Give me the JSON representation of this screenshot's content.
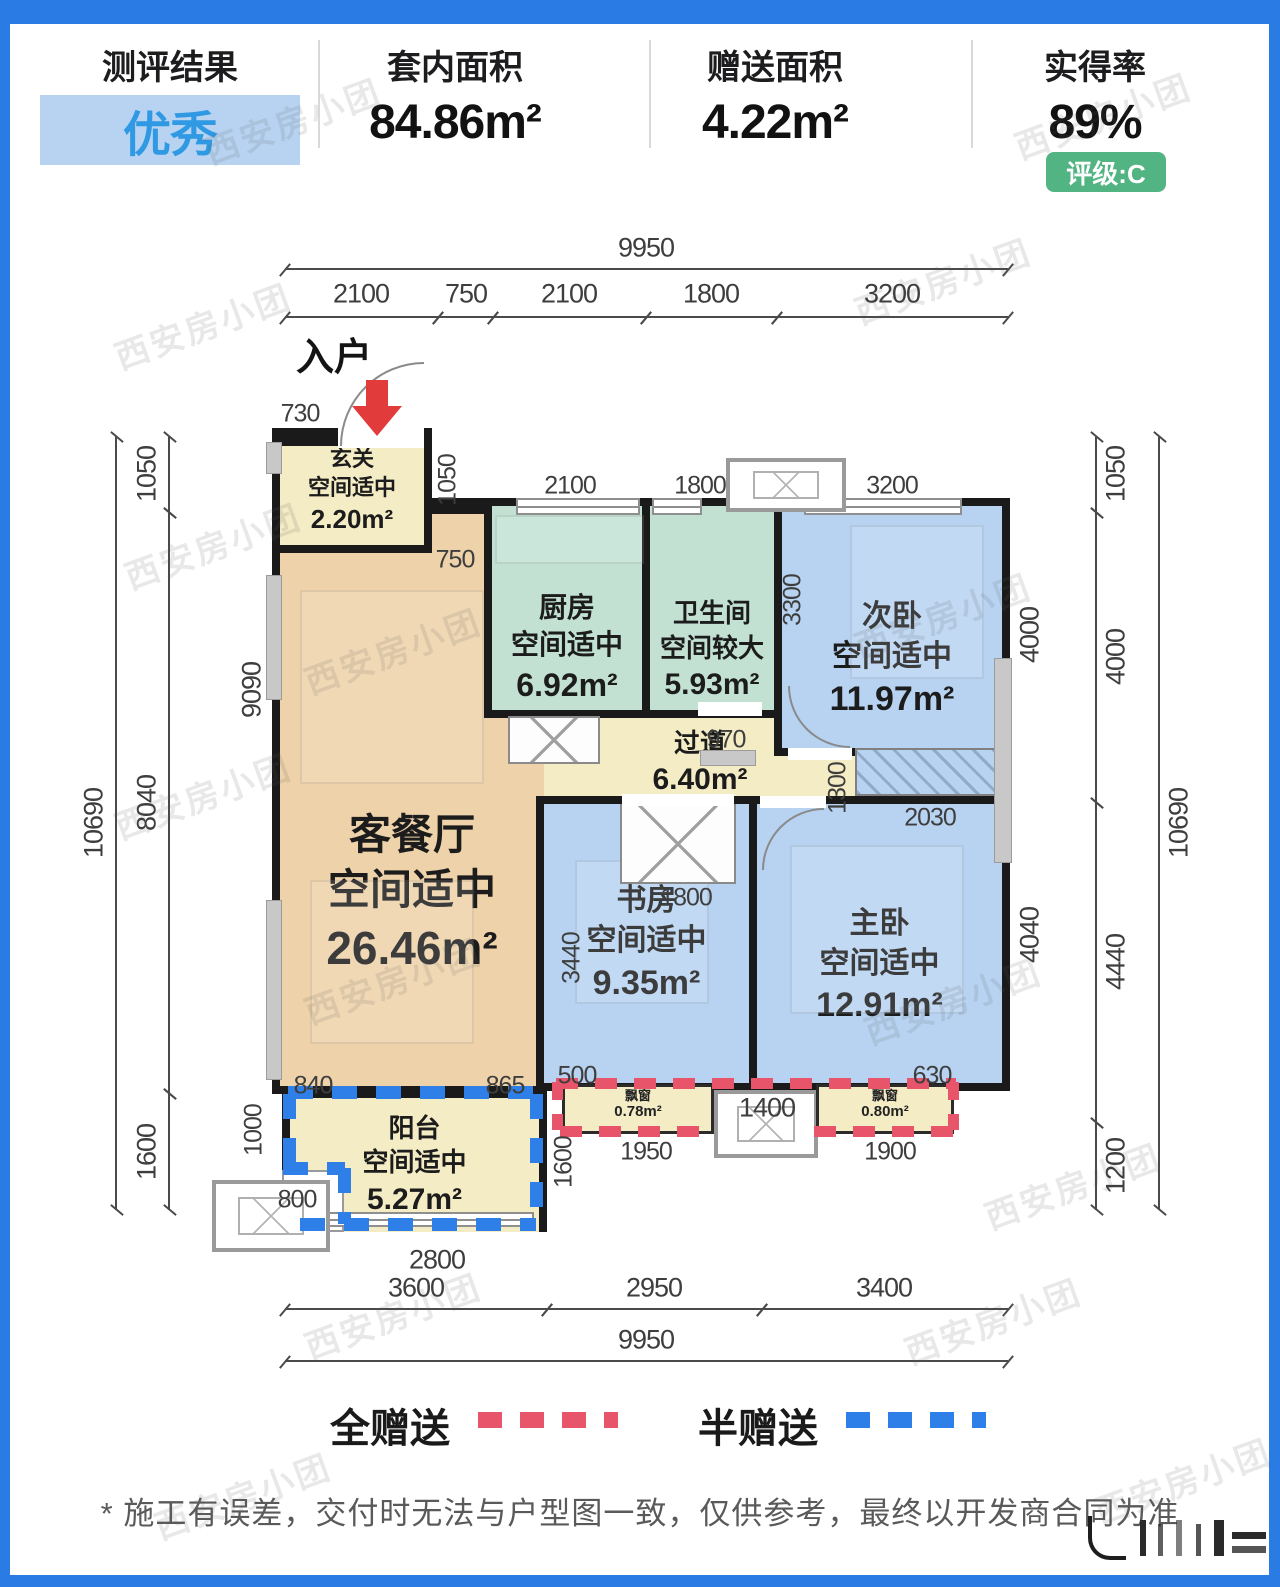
{
  "header": {
    "items": [
      {
        "label": "测评结果",
        "value": "优秀"
      },
      {
        "label": "套内面积",
        "value": "84.86m²"
      },
      {
        "label": "赠送面积",
        "value": "4.22m²"
      },
      {
        "label": "实得率",
        "value": "89%"
      }
    ],
    "rating_badge": "评级:C"
  },
  "plan": {
    "entrance_label": "入户",
    "rooms": [
      {
        "name": "玄关",
        "assessment": "空间适中",
        "area": "2.20m²"
      },
      {
        "name": "客餐厅",
        "assessment": "空间适中",
        "area": "26.46m²"
      },
      {
        "name": "厨房",
        "assessment": "空间适中",
        "area": "6.92m²"
      },
      {
        "name": "卫生间",
        "assessment": "空间较大",
        "area": "5.93m²"
      },
      {
        "name": "次卧",
        "assessment": "空间适中",
        "area": "11.97m²"
      },
      {
        "name": "过道",
        "assessment": "",
        "area": "6.40m²"
      },
      {
        "name": "书房",
        "assessment": "空间适中",
        "area": "9.35m²"
      },
      {
        "name": "主卧",
        "assessment": "空间适中",
        "area": "12.91m²"
      },
      {
        "name": "阳台",
        "assessment": "空间适中",
        "area": "5.27m²"
      }
    ],
    "bay_windows": [
      {
        "label": "飘窗",
        "area": "0.78m²"
      },
      {
        "label": "飘窗",
        "area": "0.80m²"
      }
    ],
    "dims": {
      "top_total": "9950",
      "top": [
        "2100",
        "750",
        "2100",
        "1800",
        "3200"
      ],
      "inner_top": [
        "2100",
        "1800",
        "3200"
      ],
      "hallway_top": "730",
      "entry_side": "1050",
      "entry_bottom": "750",
      "left_total": "10690",
      "left": [
        "1050",
        "8040",
        "1600"
      ],
      "left_inner": "9090",
      "right_total": "10690",
      "right": [
        "1050",
        "4000",
        "4440",
        "1200"
      ],
      "bed2_col": "4000",
      "master_col": "4040",
      "bed2_inner": "3300",
      "corridor_side": "1300",
      "wardrobe_w": "2030",
      "bath_door": "970",
      "study_door": "1800",
      "living_side": "3440",
      "seg840": "840",
      "seg865": "865",
      "seg500": "500",
      "seg630": "630",
      "balcony_side": "1000",
      "balcony_step": "800",
      "balcony_bottom": "2800",
      "balcony_right": "1600",
      "bay1_w": "1950",
      "ac_w": "1400",
      "bay2_w": "1900",
      "bottom": [
        "3600",
        "2950",
        "3400"
      ],
      "bottom_total": "9950"
    }
  },
  "legend": {
    "full_gift": "全赠送",
    "half_gift": "半赠送"
  },
  "footer": {
    "disclaimer": "* 施工有误差，交付时无法与户型图一致，仅供参考，最终以开发商合同为准"
  },
  "watermark": "西安房小团",
  "colors": {
    "frame": "#2b7be4",
    "excellent_text": "#2f99e3",
    "badge_bg": "#53b483",
    "wall": "#1a1a1a",
    "room_cream": "#f4ecc5",
    "room_tan": "#eed2a9",
    "room_teal": "#c2e1d3",
    "room_blue": "#b7d3f1",
    "gift_full_red": "#e8556a",
    "gift_half_blue": "#2e7fe8",
    "dim_text": "#3e3e3e"
  }
}
